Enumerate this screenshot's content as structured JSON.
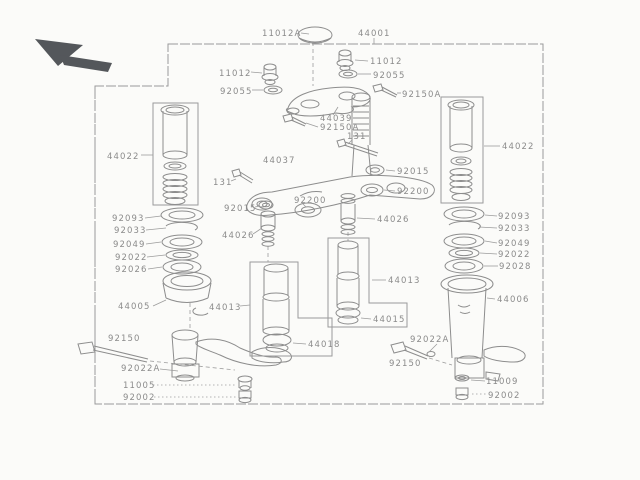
{
  "meta": {
    "description": "Exploded parts diagram of a motorcycle front fork assembly (scanned line art)",
    "assembly_number": "44001"
  },
  "colors": {
    "background": "#fbfbf9",
    "line": "#8d8d8d",
    "frame": "#9a9a9a",
    "label_text": "#8b8b8b",
    "arrow": "#54575b"
  },
  "labels": [
    {
      "id": "11012A-top-cap",
      "text": "11012A"
    },
    {
      "id": "44001-assembly",
      "text": "44001"
    },
    {
      "id": "11012-left",
      "text": "11012"
    },
    {
      "id": "92055-left",
      "text": "92055"
    },
    {
      "id": "11012-right",
      "text": "11012"
    },
    {
      "id": "92055-right",
      "text": "92055"
    },
    {
      "id": "92150A-right",
      "text": "92150A"
    },
    {
      "id": "44039-bracket",
      "text": "44039"
    },
    {
      "id": "92150A-center",
      "text": "92150A"
    },
    {
      "id": "131-upper",
      "text": "131"
    },
    {
      "id": "44037-stem",
      "text": "44037"
    },
    {
      "id": "92015-right",
      "text": "92015"
    },
    {
      "id": "131-left",
      "text": "131"
    },
    {
      "id": "92200-right",
      "text": "92200"
    },
    {
      "id": "92200-center",
      "text": "92200"
    },
    {
      "id": "92015-left",
      "text": "92015"
    },
    {
      "id": "44026-left",
      "text": "44026"
    },
    {
      "id": "44026-right",
      "text": "44026"
    },
    {
      "id": "44022-left",
      "text": "44022"
    },
    {
      "id": "44022-right",
      "text": "44022"
    },
    {
      "id": "92093-left",
      "text": "92093"
    },
    {
      "id": "92033-left",
      "text": "92033"
    },
    {
      "id": "92049-left",
      "text": "92049"
    },
    {
      "id": "92022-left",
      "text": "92022"
    },
    {
      "id": "92026-left",
      "text": "92026"
    },
    {
      "id": "92093-right",
      "text": "92093"
    },
    {
      "id": "92033-right",
      "text": "92033"
    },
    {
      "id": "92049-right",
      "text": "92049"
    },
    {
      "id": "92022-right",
      "text": "92022"
    },
    {
      "id": "92028-right",
      "text": "92028"
    },
    {
      "id": "44005-left",
      "text": "44005"
    },
    {
      "id": "44006-right",
      "text": "44006"
    },
    {
      "id": "44013-left",
      "text": "44013"
    },
    {
      "id": "44013-right",
      "text": "44013"
    },
    {
      "id": "44015",
      "text": "44015"
    },
    {
      "id": "44018",
      "text": "44018"
    },
    {
      "id": "92150-left",
      "text": "92150"
    },
    {
      "id": "92150-right",
      "text": "92150"
    },
    {
      "id": "92022A-left",
      "text": "92022A"
    },
    {
      "id": "92022A-right",
      "text": "92022A"
    },
    {
      "id": "11005-left",
      "text": "11005"
    },
    {
      "id": "11009-right",
      "text": "11009"
    },
    {
      "id": "92002-left",
      "text": "92002"
    },
    {
      "id": "92002-right",
      "text": "92002"
    }
  ]
}
